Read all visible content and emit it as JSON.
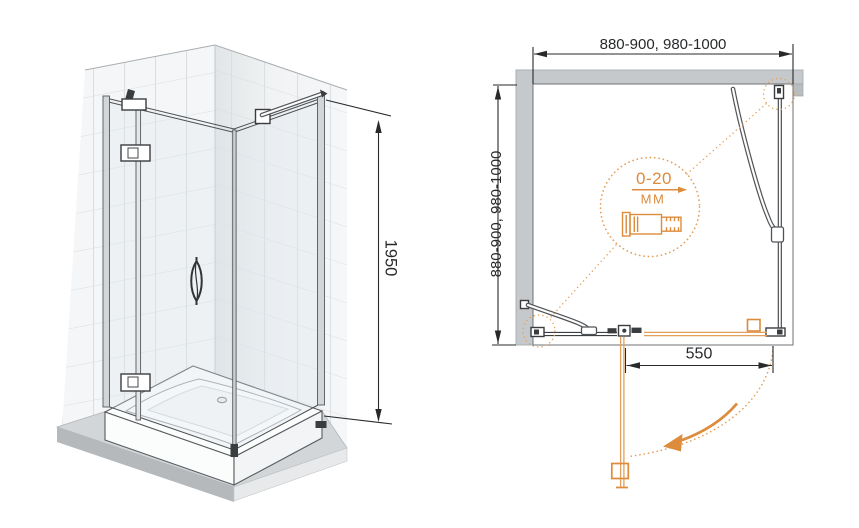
{
  "perspective_view": {
    "height_label": "1950"
  },
  "plan_view": {
    "width_label": "880-900, 980-1000",
    "depth_label": "880-900, 980-1000",
    "door_width_label": "550",
    "adjustment_detail": {
      "range_label": "0-20",
      "unit_label": "ММ"
    }
  },
  "colors": {
    "accent": "#dd8b3c",
    "accent_light": "#e4a05a",
    "ink": "#3c3f42",
    "dim_ink": "#27292b",
    "wall_fill": "#c5c9cb",
    "wall_edge": "#a9adaf",
    "tile_line": "#d9dde0",
    "wall_face": "#f5f6f7",
    "glass_tint": "#d9e5ea",
    "platform": "#d3d6d8",
    "platform_dark": "#b5b9bb",
    "hardware": "#3a3d40"
  }
}
